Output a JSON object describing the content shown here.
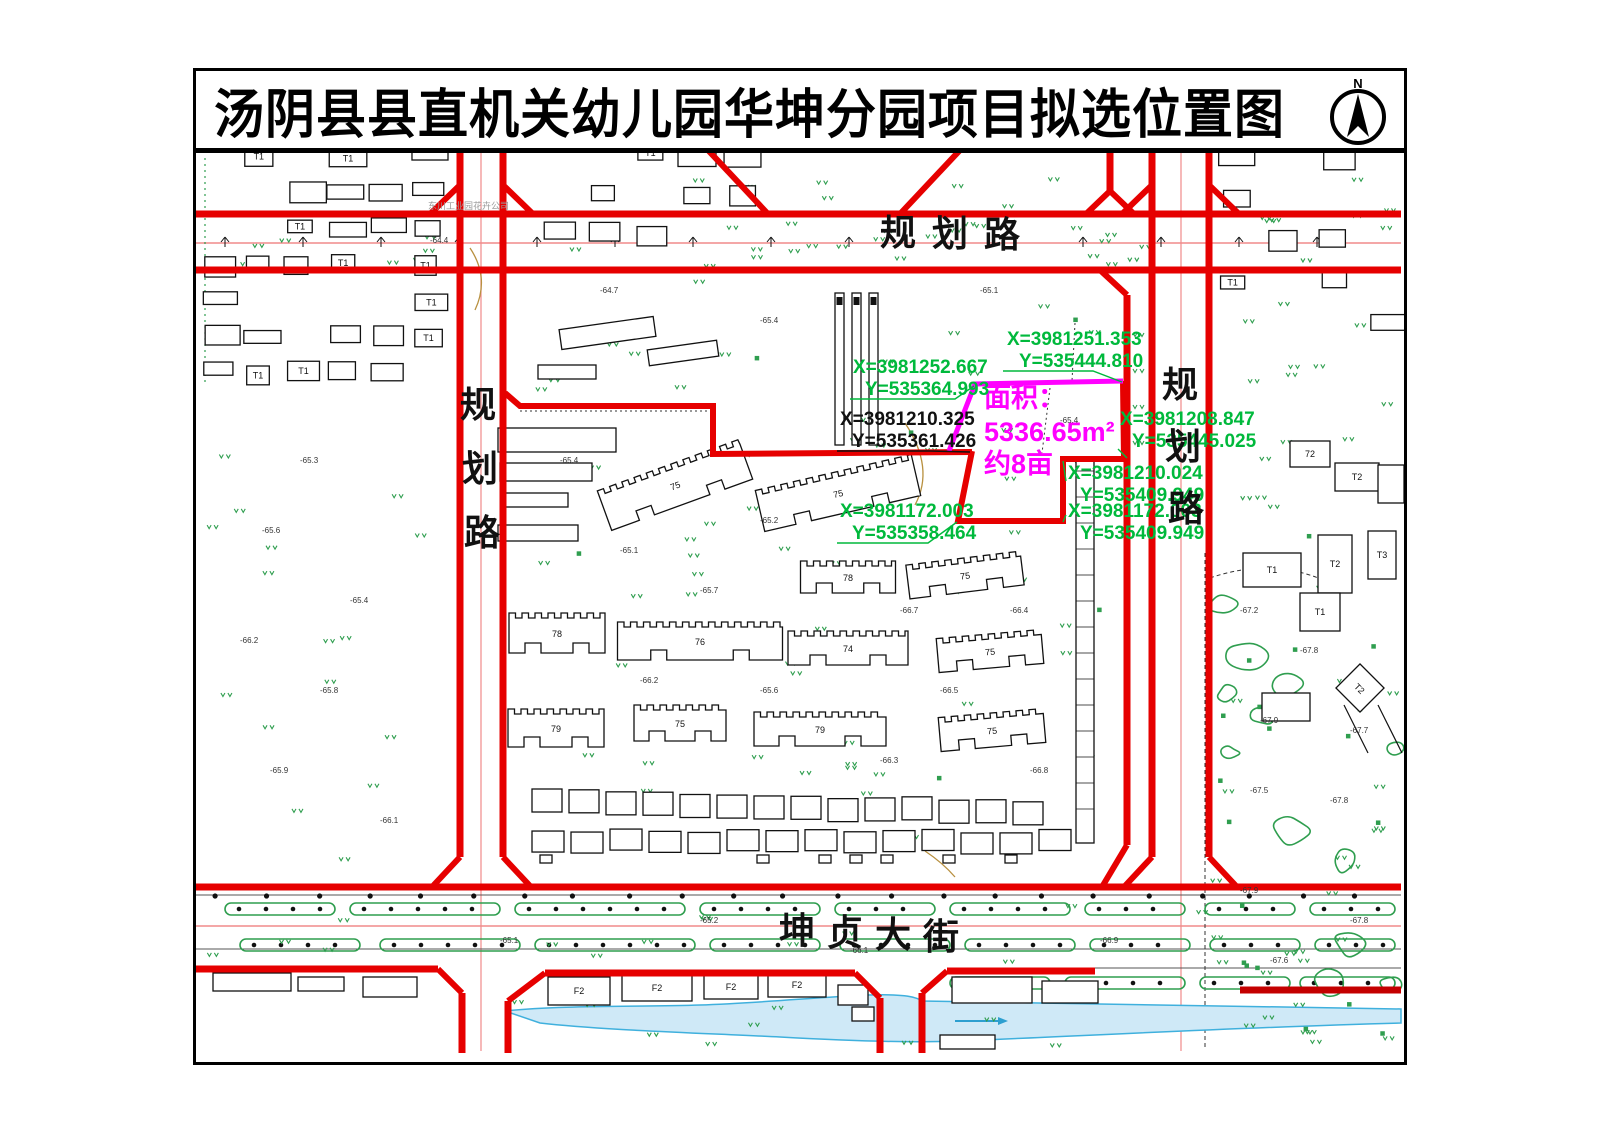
{
  "title": {
    "text": "汤阴县县直机关幼儿园华坤分园项目拟选位置图",
    "north_label": "N"
  },
  "roads": {
    "planned_road_top": "规划路",
    "planned_road_left": "规划路",
    "planned_road_right": "规划路",
    "main_street": "坤贞大街"
  },
  "parcel": {
    "area_title": "面积：",
    "area_value": "5336.65m²",
    "area_mu": "约8亩",
    "outline_color": "#ff00ff"
  },
  "coordinates": [
    {
      "x_label": "X=3981251.353",
      "y_label": "Y=535444.810",
      "color": "#00b93c",
      "tx": 1007,
      "ty": 352,
      "leader": [
        [
          1003,
          378
        ],
        [
          1093,
          378
        ],
        [
          1122,
          389
        ]
      ]
    },
    {
      "x_label": "X=3981252.667",
      "y_label": "Y=535364.993",
      "color": "#00b93c",
      "tx": 853,
      "ty": 380,
      "leader": [
        [
          850,
          406
        ],
        [
          955,
          406
        ],
        [
          974,
          393
        ]
      ]
    },
    {
      "x_label": "X=3981210.325",
      "y_label": "Y=535361.426",
      "color": "#111111",
      "tx": 840,
      "ty": 432,
      "leader": [
        [
          837,
          458
        ],
        [
          930,
          458
        ],
        [
          970,
          459
        ]
      ]
    },
    {
      "x_label": "X=3981208.847",
      "y_label": "Y=535445.025",
      "color": "#00b93c",
      "tx": 1120,
      "ty": 432,
      "leader": [
        [
          1118,
          456
        ],
        [
          1127,
          465
        ]
      ]
    },
    {
      "x_label": "X=3981210.024",
      "y_label": "Y=535409.949",
      "color": "#00b93c",
      "tx": 1068,
      "ty": 486,
      "leader": [
        [
          1066,
          488
        ],
        [
          1063,
          468
        ]
      ]
    },
    {
      "x_label": "X=3981172.003",
      "y_label": "Y=535358.464",
      "color": "#00b93c",
      "tx": 840,
      "ty": 524,
      "leader": [
        [
          837,
          550
        ],
        [
          928,
          550
        ],
        [
          957,
          529
        ]
      ]
    },
    {
      "x_label": "X=3981172.003",
      "y_label": "Y=535409.949",
      "color": "#00b93c",
      "tx": 1068,
      "ty": 524,
      "leader": [
        [
          1066,
          522
        ],
        [
          1063,
          529
        ]
      ]
    }
  ],
  "buildings": {
    "residential_labels": [
      "75",
      "75",
      "78",
      "76",
      "78",
      "75",
      "74",
      "79",
      "75",
      "79",
      "75",
      "75"
    ],
    "bottom_labels": [
      "F2",
      "F2",
      "F2",
      "F2"
    ],
    "right_labels": [
      "T1",
      "T2",
      "T3",
      "T1",
      "T2",
      "72",
      "T2",
      "T1"
    ],
    "small_label": "T1"
  },
  "misc": {
    "company_label": "东川工业园花卉公司"
  },
  "spot_elevations": [
    {
      "x": 300,
      "y": 470,
      "v": "-65.3"
    },
    {
      "x": 262,
      "y": 540,
      "v": "-65.6"
    },
    {
      "x": 350,
      "y": 610,
      "v": "-65.4"
    },
    {
      "x": 240,
      "y": 650,
      "v": "-66.2"
    },
    {
      "x": 320,
      "y": 700,
      "v": "-65.8"
    },
    {
      "x": 270,
      "y": 780,
      "v": "-65.9"
    },
    {
      "x": 380,
      "y": 830,
      "v": "-66.1"
    },
    {
      "x": 560,
      "y": 470,
      "v": "-65.4"
    },
    {
      "x": 620,
      "y": 560,
      "v": "-65.1"
    },
    {
      "x": 700,
      "y": 600,
      "v": "-65.7"
    },
    {
      "x": 760,
      "y": 530,
      "v": "-65.2"
    },
    {
      "x": 640,
      "y": 690,
      "v": "-66.2"
    },
    {
      "x": 760,
      "y": 700,
      "v": "-65.6"
    },
    {
      "x": 900,
      "y": 620,
      "v": "-66.7"
    },
    {
      "x": 940,
      "y": 700,
      "v": "-66.5"
    },
    {
      "x": 880,
      "y": 770,
      "v": "-66.3"
    },
    {
      "x": 1010,
      "y": 620,
      "v": "-66.4"
    },
    {
      "x": 1030,
      "y": 780,
      "v": "-66.8"
    },
    {
      "x": 1240,
      "y": 620,
      "v": "-67.2"
    },
    {
      "x": 1300,
      "y": 660,
      "v": "-67.8"
    },
    {
      "x": 1260,
      "y": 730,
      "v": "-67.9"
    },
    {
      "x": 1350,
      "y": 740,
      "v": "-67.7"
    },
    {
      "x": 1250,
      "y": 800,
      "v": "-67.5"
    },
    {
      "x": 1330,
      "y": 810,
      "v": "-67.8"
    },
    {
      "x": 1240,
      "y": 900,
      "v": "-67.9"
    },
    {
      "x": 1350,
      "y": 930,
      "v": "-67.8"
    },
    {
      "x": 1270,
      "y": 970,
      "v": "-67.6"
    },
    {
      "x": 600,
      "y": 300,
      "v": "-64.7"
    },
    {
      "x": 760,
      "y": 330,
      "v": "-65.4"
    },
    {
      "x": 980,
      "y": 300,
      "v": "-65.1"
    },
    {
      "x": 1060,
      "y": 430,
      "v": "-65.4"
    },
    {
      "x": 700,
      "y": 930,
      "v": "-65.2"
    },
    {
      "x": 500,
      "y": 950,
      "v": "-65.1"
    },
    {
      "x": 850,
      "y": 960,
      "v": "-66.1"
    },
    {
      "x": 1100,
      "y": 950,
      "v": "-66.9"
    },
    {
      "x": 430,
      "y": 250,
      "v": "-64.4"
    }
  ],
  "colors": {
    "road_red": "#e60000",
    "road_red_dark": "#c40000",
    "parcel_magenta": "#ff00ff",
    "coord_green": "#00b93c",
    "veg_green": "#2f9e4f",
    "water_fill": "#cfe9f7",
    "water_stroke": "#3fb0dd",
    "centerline_pink": "#f08a8a"
  }
}
